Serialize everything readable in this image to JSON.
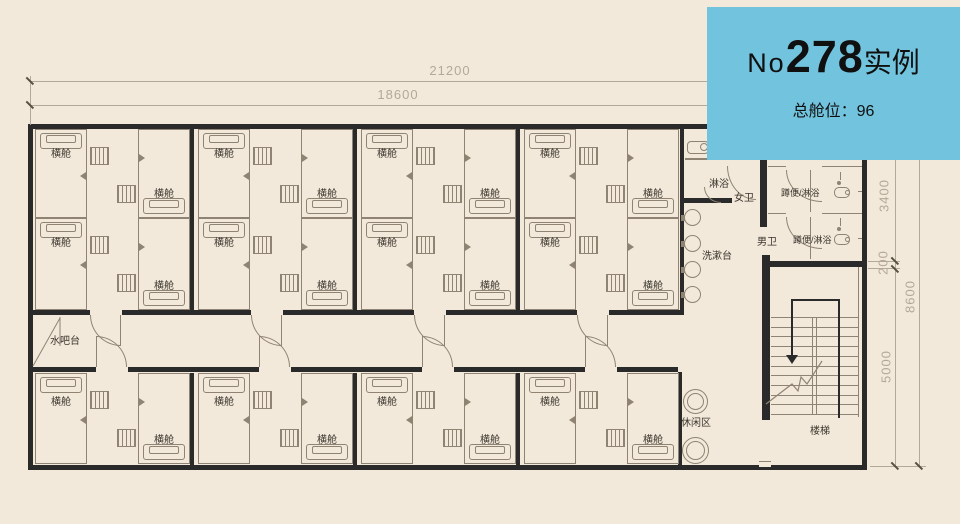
{
  "info_panel": {
    "title_prefix": "No",
    "title_number": "278",
    "title_suffix": "实例",
    "subtitle": "总舱位：96"
  },
  "dimensions": {
    "top_total": "21200",
    "top_inner": "18600",
    "right_upper": "3400",
    "right_wall": "200",
    "right_lower": "5000",
    "right_total": "8600"
  },
  "labels": {
    "capsule": "横舱",
    "water_bar": "水吧台",
    "shower": "淋浴",
    "female_wc": "女卫",
    "male_wc": "男卫",
    "squat_toilet_shower": "蹲便/淋浴",
    "washstand": "洗漱台",
    "lounge": "休闲区",
    "stairs": "楼梯"
  },
  "colors": {
    "background": "#f2e9da",
    "panel_blue": "#72c3dd",
    "wall_black": "#2a2a2a",
    "drawing_line": "#8f8473",
    "dimension_gray": "#b3a998",
    "label_text": "#3a342c",
    "panel_text": "#101010"
  }
}
